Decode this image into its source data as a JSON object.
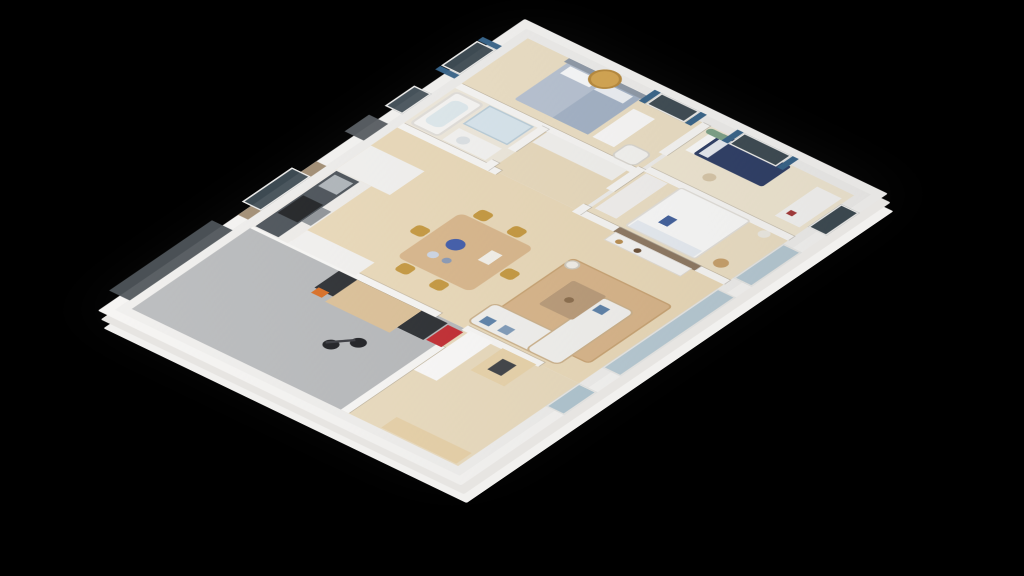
{
  "scene": {
    "description": "isometric 3d floor plan render of a house on black background",
    "background_color": "#000000",
    "wall_color": "#f5f4f2",
    "wood_floor_color": "#ead9b8",
    "garage_floor_color": "#b6b8ba",
    "accent_curtain_color": "#386489",
    "accent_gold_color": "#c5973c"
  },
  "rooms": [
    {
      "name": "floor-garage",
      "label": "garage",
      "x": 12,
      "y": 12,
      "w": 188,
      "h": 278,
      "color": "#b6b8ba"
    },
    {
      "name": "floor-entry-office",
      "label": "entry-office",
      "x": 12,
      "y": 290,
      "w": 188,
      "h": 148,
      "color": "#e9dabc"
    },
    {
      "name": "floor-kitchen-living",
      "label": "kitchen-dining-living",
      "x": 200,
      "y": 12,
      "w": 230,
      "h": 426,
      "color": "#ead9b8"
    },
    {
      "name": "floor-bathroom",
      "label": "bathroom",
      "x": 430,
      "y": 12,
      "w": 90,
      "h": 118,
      "color": "#efe9dc"
    },
    {
      "name": "floor-hallway",
      "label": "hallway",
      "x": 430,
      "y": 130,
      "w": 90,
      "h": 115,
      "color": "#e9dabc"
    },
    {
      "name": "floor-master-bedroom",
      "label": "master-bedroom",
      "x": 520,
      "y": 12,
      "w": 108,
      "h": 233,
      "color": "#ecdfc4"
    },
    {
      "name": "floor-bedroom-2",
      "label": "bedroom-2",
      "x": 430,
      "y": 250,
      "w": 100,
      "h": 188,
      "color": "#ecdfc4"
    },
    {
      "name": "floor-bedroom-3",
      "label": "bedroom-3",
      "x": 530,
      "y": 250,
      "w": 98,
      "h": 188,
      "color": "#f0e7d2"
    }
  ],
  "walls": [
    {
      "name": "wall-garage-right-upper",
      "x": 196,
      "y": 12,
      "w": 10,
      "h": 242
    },
    {
      "name": "wall-garage-right-lower",
      "x": 196,
      "y": 288,
      "w": 10,
      "h": 100
    },
    {
      "name": "wall-garage-office",
      "x": 12,
      "y": 285,
      "w": 150,
      "h": 10
    },
    {
      "name": "wall-kitchen-bath",
      "x": 425,
      "y": 12,
      "w": 10,
      "h": 128
    },
    {
      "name": "wall-living-bedroom2",
      "x": 425,
      "y": 250,
      "w": 10,
      "h": 188
    },
    {
      "name": "wall-tv-backpanel",
      "x": 425,
      "y": 294,
      "w": 10,
      "h": 106,
      "color": "#8d7760"
    },
    {
      "name": "wall-bath-master",
      "x": 515,
      "y": 12,
      "w": 10,
      "h": 233
    },
    {
      "name": "wall-bath-hall-a",
      "x": 425,
      "y": 120,
      "w": 18,
      "h": 10
    },
    {
      "name": "wall-bath-hall-b",
      "x": 468,
      "y": 120,
      "w": 52,
      "h": 10
    },
    {
      "name": "wall-hall-bedrooms-a",
      "x": 425,
      "y": 240,
      "w": 18,
      "h": 10
    },
    {
      "name": "wall-hall-bedrooms-b",
      "x": 478,
      "y": 240,
      "w": 50,
      "h": 10
    },
    {
      "name": "wall-hall-bedrooms-c",
      "x": 560,
      "y": 240,
      "w": 68,
      "h": 10
    },
    {
      "name": "wall-bedroom2-bedroom3",
      "x": 525,
      "y": 250,
      "w": 10,
      "h": 188
    }
  ],
  "furniture": [
    {
      "name": "bicycle-wheel-front",
      "x": 84,
      "y": 196,
      "w": 17,
      "h": 17,
      "shape": "circle",
      "color": "#17181c"
    },
    {
      "name": "bicycle-wheel-rear",
      "x": 104,
      "y": 215,
      "w": 17,
      "h": 17,
      "shape": "circle",
      "color": "#17181c"
    },
    {
      "name": "bicycle-frame",
      "x": 88,
      "y": 206,
      "w": 30,
      "h": 4,
      "rotate": 42,
      "color": "#33343a"
    },
    {
      "name": "garage-workbench",
      "x": 158,
      "y": 128,
      "w": 38,
      "h": 142,
      "color": "#26292d"
    },
    {
      "name": "garage-workbench-top",
      "x": 146,
      "y": 152,
      "w": 50,
      "h": 84,
      "color": "#dcc096"
    },
    {
      "name": "garage-chainsaw",
      "x": 149,
      "y": 131,
      "w": 12,
      "h": 14,
      "color": "#d96b1f"
    },
    {
      "name": "garage-tool-cart",
      "x": 160,
      "y": 272,
      "w": 34,
      "h": 20,
      "color": "#c1272d"
    },
    {
      "name": "office-wood-bookcase",
      "x": 14,
      "y": 336,
      "w": 24,
      "h": 98,
      "color": "#e6cfa5",
      "pattern": "books-v"
    },
    {
      "name": "office-white-bookshelf",
      "x": 112,
      "y": 296,
      "w": 88,
      "h": 30,
      "color": "#fbfaf9",
      "pattern": "books-h"
    },
    {
      "name": "office-bench",
      "x": 148,
      "y": 340,
      "w": 50,
      "h": 44,
      "color": "#e8d2a8"
    },
    {
      "name": "office-bench-tray",
      "x": 160,
      "y": 352,
      "w": 24,
      "h": 18,
      "color": "#3b3e42"
    },
    {
      "name": "kitchen-cabinet-run",
      "x": 200,
      "y": 12,
      "w": 130,
      "h": 46,
      "color": "#efedea"
    },
    {
      "name": "kitchen-counter",
      "x": 202,
      "y": 14,
      "w": 126,
      "h": 30,
      "color": "#464d54"
    },
    {
      "name": "kitchen-sink",
      "x": 296,
      "y": 17,
      "w": 26,
      "h": 24,
      "color": "#aeb4b9"
    },
    {
      "name": "kitchen-cooktop",
      "x": 234,
      "y": 16,
      "w": 40,
      "h": 26,
      "color": "#191b1e",
      "pattern": "burners"
    },
    {
      "name": "kitchen-oven",
      "x": 238,
      "y": 44,
      "w": 32,
      "h": 12,
      "color": "#8c9196"
    },
    {
      "name": "kitchen-tall-cabinet",
      "x": 330,
      "y": 12,
      "w": 54,
      "h": 70,
      "color": "#f3f2f0"
    },
    {
      "name": "kitchen-fridge-cabinet",
      "x": 200,
      "y": 58,
      "w": 30,
      "h": 88,
      "color": "#f3f2f0"
    },
    {
      "name": "dining-table",
      "x": 252,
      "y": 156,
      "w": 100,
      "h": 96,
      "radius": 8,
      "color": "#d9b68a"
    },
    {
      "name": "dining-platter-blue",
      "x": 296,
      "y": 178,
      "w": 20,
      "h": 20,
      "shape": "circle",
      "color": "#3d59a9"
    },
    {
      "name": "dining-vase-1",
      "x": 272,
      "y": 176,
      "w": 12,
      "h": 12,
      "shape": "circle",
      "color": "#cdd6e4"
    },
    {
      "name": "dining-vase-2",
      "x": 274,
      "y": 194,
      "w": 10,
      "h": 10,
      "shape": "circle",
      "color": "#8898b4"
    },
    {
      "name": "dining-book",
      "x": 300,
      "y": 222,
      "w": 22,
      "h": 14,
      "color": "#f4f1ea"
    },
    {
      "name": "dining-chair-1",
      "x": 233,
      "y": 168,
      "w": 17,
      "h": 17,
      "radius": 5,
      "color": "#c5973c"
    },
    {
      "name": "dining-chair-2",
      "x": 233,
      "y": 212,
      "w": 17,
      "h": 17,
      "radius": 5,
      "color": "#c5973c"
    },
    {
      "name": "dining-chair-3",
      "x": 354,
      "y": 168,
      "w": 17,
      "h": 17,
      "radius": 5,
      "color": "#c5973c"
    },
    {
      "name": "dining-chair-4",
      "x": 354,
      "y": 212,
      "w": 17,
      "h": 17,
      "radius": 5,
      "color": "#c5973c"
    },
    {
      "name": "dining-chair-5",
      "x": 293,
      "y": 137,
      "w": 17,
      "h": 17,
      "radius": 5,
      "color": "#c5973c"
    },
    {
      "name": "dining-chair-6",
      "x": 293,
      "y": 254,
      "w": 17,
      "h": 17,
      "radius": 5,
      "color": "#c5973c"
    },
    {
      "name": "living-rug",
      "x": 232,
      "y": 292,
      "w": 132,
      "h": 132,
      "radius": 6,
      "color": "#d8b488",
      "border": "2px solid #c8a271"
    },
    {
      "name": "sofa-left-arm",
      "x": 210,
      "y": 282,
      "w": 44,
      "h": 120,
      "radius": 8,
      "color": "#f2f1ee",
      "border": "2px solid #cbb089"
    },
    {
      "name": "sofa-bottom-arm",
      "x": 210,
      "y": 358,
      "w": 122,
      "h": 44,
      "radius": 8,
      "color": "#f2f1ee",
      "border": "2px solid #cbb089"
    },
    {
      "name": "sofa-pillow-1",
      "x": 218,
      "y": 292,
      "w": 13,
      "h": 13,
      "color": "#5b80a8"
    },
    {
      "name": "sofa-pillow-2",
      "x": 218,
      "y": 316,
      "w": 13,
      "h": 13,
      "color": "#7d99b8"
    },
    {
      "name": "sofa-pillow-3",
      "x": 306,
      "y": 366,
      "w": 13,
      "h": 13,
      "color": "#5b80a8"
    },
    {
      "name": "coffee-table",
      "x": 280,
      "y": 318,
      "w": 54,
      "h": 44,
      "radius": 3,
      "color": "#b99a77",
      "pattern": "pallet"
    },
    {
      "name": "coffee-table-bowl",
      "x": 300,
      "y": 332,
      "w": 10,
      "h": 10,
      "shape": "circle",
      "color": "#8a6b4a"
    },
    {
      "name": "floor-lamp",
      "x": 346,
      "y": 292,
      "w": 16,
      "h": 16,
      "shape": "circle",
      "color": "#f2efe8",
      "border": "2px solid #cfcabd"
    },
    {
      "name": "tv-console",
      "x": 408,
      "y": 296,
      "w": 18,
      "h": 100,
      "color": "#f6f5f3",
      "border": "1px solid #ddd9d3"
    },
    {
      "name": "tv-console-vase-1",
      "x": 411,
      "y": 306,
      "w": 8,
      "h": 8,
      "shape": "circle",
      "color": "#b98d4f"
    },
    {
      "name": "tv-console-vase-2",
      "x": 411,
      "y": 330,
      "w": 8,
      "h": 8,
      "shape": "circle",
      "color": "#6b4f35"
    },
    {
      "name": "bedroom2-dresser",
      "x": 444,
      "y": 254,
      "w": 80,
      "h": 28,
      "color": "#f3f1ef",
      "pattern": "dash"
    },
    {
      "name": "bedroom2-bed",
      "x": 440,
      "y": 296,
      "w": 88,
      "h": 92,
      "radius": 4,
      "color": "#fbfbfa",
      "border": "2px solid #e3e0da"
    },
    {
      "name": "bedroom2-pillow",
      "x": 442,
      "y": 300,
      "w": 14,
      "h": 84,
      "color": "#e8edf3"
    },
    {
      "name": "bedroom2-throw",
      "x": 466,
      "y": 318,
      "w": 16,
      "h": 12,
      "color": "#41609c"
    },
    {
      "name": "bedroom2-basket",
      "x": 444,
      "y": 404,
      "w": 16,
      "h": 16,
      "shape": "circle",
      "color": "#c8a06a"
    },
    {
      "name": "bedroom2-lamp",
      "x": 512,
      "y": 406,
      "w": 13,
      "h": 13,
      "shape": "circle",
      "color": "#eeebe4"
    },
    {
      "name": "bedroom3-bed-headboard",
      "x": 580,
      "y": 258,
      "w": 46,
      "h": 12,
      "color": "#fcfcfb"
    },
    {
      "name": "bedroom3-bed-navy",
      "x": 580,
      "y": 268,
      "w": 46,
      "h": 90,
      "radius": 3,
      "color": "#2e3e66"
    },
    {
      "name": "bedroom3-pillow",
      "x": 584,
      "y": 272,
      "w": 38,
      "h": 12,
      "color": "#e8ecf2"
    },
    {
      "name": "bedroom3-dresser",
      "x": 550,
      "y": 400,
      "w": 66,
      "h": 32,
      "color": "#f5f4f2",
      "pattern": "dash"
    },
    {
      "name": "bedroom3-dresser-deco",
      "x": 560,
      "y": 406,
      "w": 8,
      "h": 8,
      "color": "#a43a3a"
    },
    {
      "name": "bedroom3-wall-plant",
      "x": 616,
      "y": 252,
      "w": 10,
      "h": 26,
      "radius": 5,
      "color": "#7da287"
    },
    {
      "name": "bedroom3-stool",
      "x": 552,
      "y": 300,
      "w": 14,
      "h": 14,
      "shape": "circle",
      "color": "#d8c7a8"
    },
    {
      "name": "master-bed",
      "x": 538,
      "y": 70,
      "w": 86,
      "h": 96,
      "radius": 3,
      "color": "#b7c2d2"
    },
    {
      "name": "master-duvet-fold",
      "x": 538,
      "y": 120,
      "w": 86,
      "h": 46,
      "color": "#a3b2c6"
    },
    {
      "name": "master-pillow-1",
      "x": 602,
      "y": 76,
      "w": 16,
      "h": 38,
      "color": "#fafbfc"
    },
    {
      "name": "master-pillow-2",
      "x": 602,
      "y": 120,
      "w": 16,
      "h": 38,
      "color": "#eef1f5"
    },
    {
      "name": "master-headboard",
      "x": 620,
      "y": 66,
      "w": 8,
      "h": 104,
      "color": "#8e99a7"
    },
    {
      "name": "master-shell-art",
      "x": 606,
      "y": 100,
      "w": 34,
      "h": 34,
      "shape": "circle",
      "color": "#d5a54f",
      "border": "3px solid #b8893a"
    },
    {
      "name": "master-cubby-shelf",
      "x": 538,
      "y": 172,
      "w": 64,
      "h": 28,
      "color": "#fbfaf9",
      "pattern": "dash"
    },
    {
      "name": "master-armchair",
      "x": 524,
      "y": 206,
      "w": 30,
      "h": 32,
      "radius": 8,
      "color": "#f6f5f2",
      "border": "2px solid #d9d6cf"
    },
    {
      "name": "bathtub",
      "x": 438,
      "y": 16,
      "w": 74,
      "h": 38,
      "radius": 6,
      "color": "#f8f7f5",
      "border": "3px solid #e2dfda"
    },
    {
      "name": "bathtub-water",
      "x": 450,
      "y": 24,
      "w": 50,
      "h": 22,
      "radius": 8,
      "color": "#dfeaee"
    },
    {
      "name": "bath-vanity",
      "x": 438,
      "y": 60,
      "w": 26,
      "h": 56,
      "color": "#f5f4f2"
    },
    {
      "name": "bath-sink",
      "x": 443,
      "y": 70,
      "w": 14,
      "h": 14,
      "shape": "circle",
      "color": "#dde2e5"
    },
    {
      "name": "shower",
      "x": 472,
      "y": 58,
      "w": 42,
      "h": 58,
      "color": "#d8e6ee",
      "border": "2px solid #b9cdd9"
    },
    {
      "name": "hall-wardrobe",
      "x": 492,
      "y": 132,
      "w": 24,
      "h": 104,
      "color": "#f3f2ef",
      "pattern": "shelves"
    }
  ],
  "wall_openings": [
    {
      "name": "kitchen-backsplash",
      "x": 206,
      "y": -12,
      "w": 122,
      "h": 13,
      "color": "#9f8a6f"
    },
    {
      "name": "garage-door",
      "x": 22,
      "y": -26,
      "w": 160,
      "h": 27,
      "color": "#4a5055",
      "pattern": "panels"
    },
    {
      "name": "kitchen-window",
      "x": 226,
      "y": -24,
      "w": 78,
      "h": 25,
      "color": "#3d4a52",
      "border": "2px solid #f0efed"
    },
    {
      "name": "entry-door",
      "x": 386,
      "y": -24,
      "w": 38,
      "h": 25,
      "color": "#565b60"
    },
    {
      "name": "bathroom-window",
      "x": 446,
      "y": -22,
      "w": 46,
      "h": 23,
      "color": "#46525a",
      "border": "2px solid #f0efed"
    },
    {
      "name": "master-window-top",
      "x": 536,
      "y": -24,
      "w": 56,
      "h": 25,
      "color": "#3d4a52",
      "border": "2px solid #f0efed"
    },
    {
      "name": "master-curtain-top-left",
      "x": 527,
      "y": -24,
      "w": 8,
      "h": 25,
      "color": "#386489"
    },
    {
      "name": "master-curtain-top-right",
      "x": 593,
      "y": -24,
      "w": 8,
      "h": 25,
      "color": "#386489"
    },
    {
      "name": "master-window-side",
      "x": 616,
      "y": 176,
      "w": 25,
      "h": 50,
      "color": "#3d4a52",
      "border": "2px solid #f0efed"
    },
    {
      "name": "master-curtain-side-a",
      "x": 616,
      "y": 167,
      "w": 25,
      "h": 8,
      "color": "#386489"
    },
    {
      "name": "master-curtain-side-b",
      "x": 616,
      "y": 227,
      "w": 25,
      "h": 8,
      "color": "#386489"
    },
    {
      "name": "bedroom3-window-side",
      "x": 616,
      "y": 284,
      "w": 25,
      "h": 62,
      "color": "#3d4a52",
      "border": "2px solid #f0efed"
    },
    {
      "name": "bedroom3-curtain-a",
      "x": 616,
      "y": 275,
      "w": 25,
      "h": 8,
      "color": "#386489"
    },
    {
      "name": "bedroom3-curtain-b",
      "x": 616,
      "y": 347,
      "w": 25,
      "h": 8,
      "color": "#386489"
    },
    {
      "name": "office-glass-door",
      "x": 148,
      "y": 438,
      "w": 52,
      "h": 24,
      "color": "#aec4cf",
      "pattern": "mullion"
    },
    {
      "name": "living-sliding-doors",
      "x": 236,
      "y": 438,
      "w": 180,
      "h": 24,
      "color": "#b6c9d3",
      "pattern": "mullion"
    },
    {
      "name": "bedroom2-sliding-door",
      "x": 440,
      "y": 438,
      "w": 78,
      "h": 24,
      "color": "#b6c9d3",
      "pattern": "mullion"
    },
    {
      "name": "bedroom3-low-window",
      "x": 556,
      "y": 438,
      "w": 52,
      "h": 24,
      "color": "#3d4a52",
      "border": "2px solid #f0efed"
    }
  ]
}
